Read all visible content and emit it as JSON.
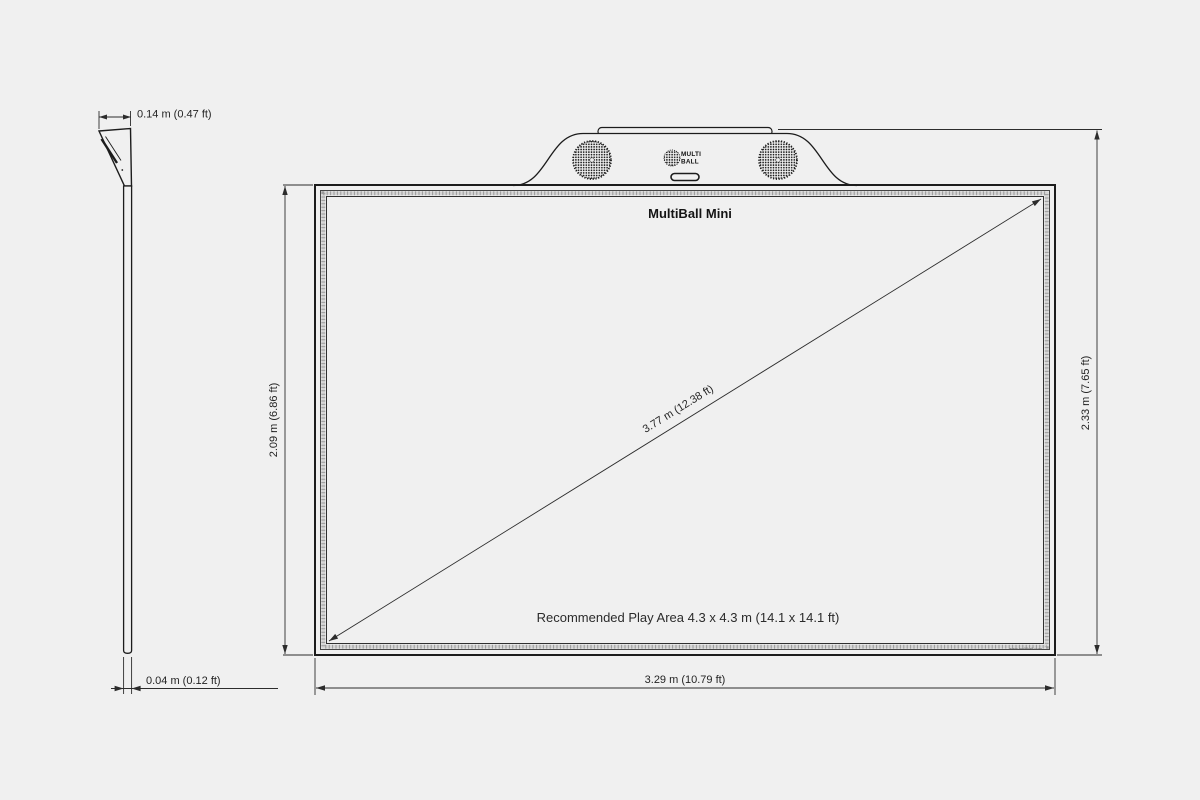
{
  "page": {
    "background_color": "#f0f0f0",
    "line_color": "#1c1c1c"
  },
  "side_view": {
    "depth_dimension": "0.14 m (0.47 ft)",
    "thickness_dimension": "0.04 m (0.12 ft)"
  },
  "front_view": {
    "model_name": "MultiBall Mini",
    "logo": {
      "line1": "MULTI",
      "line2": "BALL"
    },
    "screen_height_dimension": "2.09 m (6.86 ft)",
    "total_height_dimension": "2.33 m (7.65 ft)",
    "width_dimension": "3.29 m (10.79 ft)",
    "diagonal_dimension": "3.77 m (12.38 ft)",
    "play_area_note": "Recommended Play Area 4.3 x 4.3 m (14.1 x 14.1 ft)",
    "footer_text": "www.multiball.com"
  }
}
